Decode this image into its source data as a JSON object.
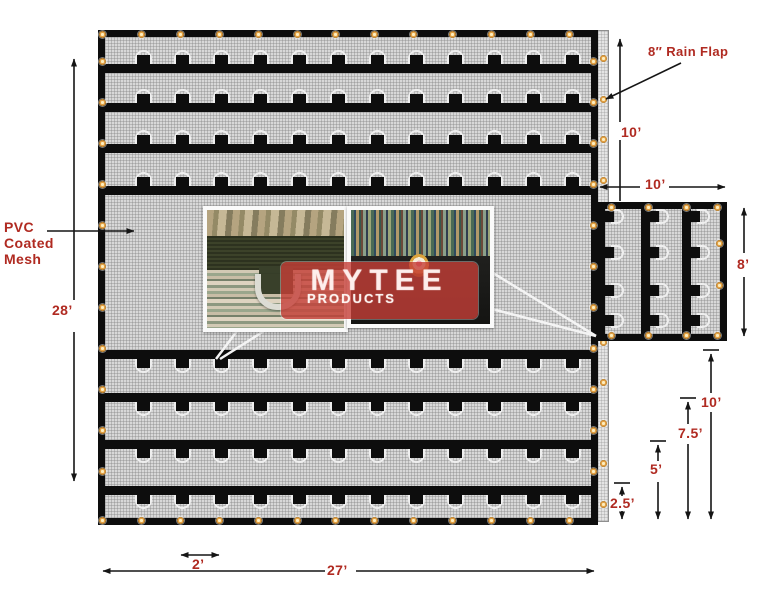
{
  "annotations": {
    "material": {
      "line1": "PVC",
      "line2": "Coated",
      "line3": "Mesh"
    },
    "rain_flap": "8″ Rain Flap",
    "dims": {
      "main_height": "28’",
      "main_width": "27’",
      "tab_spacing": "2’",
      "flap_section": "10’",
      "side_width": "10’",
      "side_height": "8’",
      "ladder_10": "10’",
      "ladder_7_5": "7.5’",
      "ladder_5": "5’",
      "ladder_2_5": "2.5’"
    }
  },
  "logo": {
    "name": "MYTEE",
    "subtitle": "PRODUCTS"
  },
  "colors": {
    "label_red": "#b02a21",
    "tarp_black": "#0d0d0d",
    "mesh_gray": "#d8d8d8",
    "grommet_orange": "#e2a045",
    "logo_red": "#c63e37"
  }
}
